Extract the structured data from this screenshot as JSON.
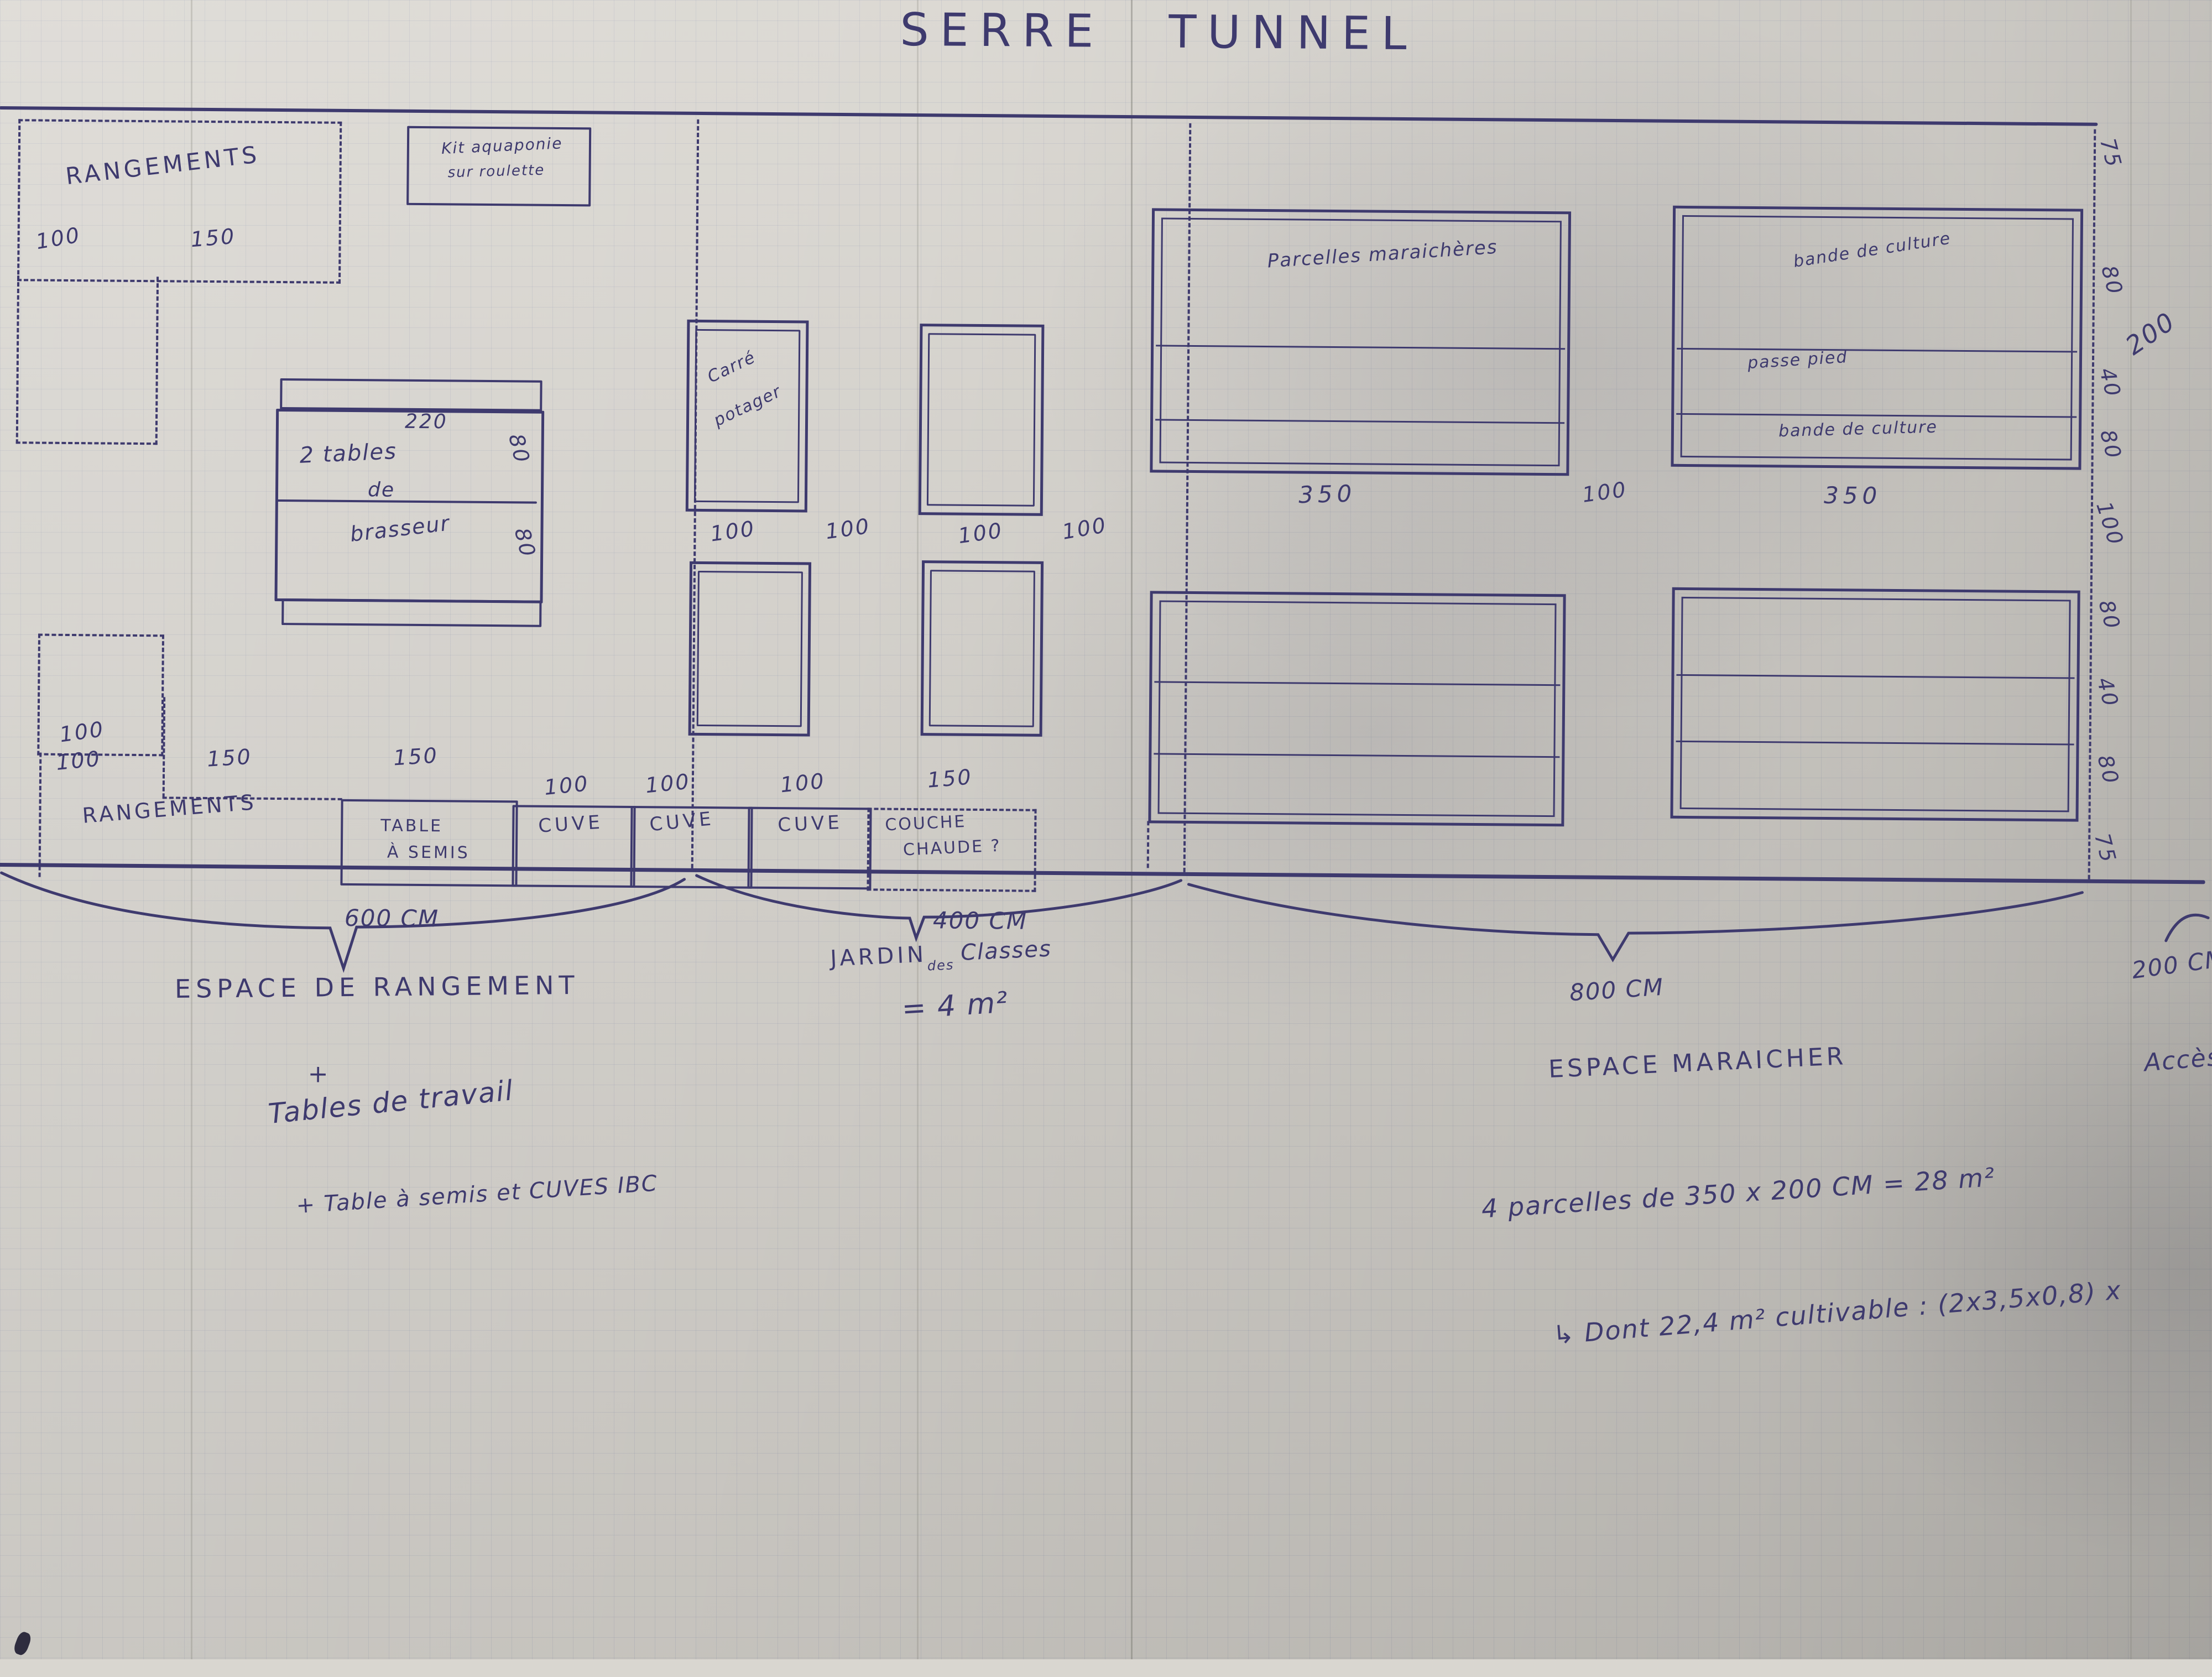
{
  "title": "SERRE TUNNEL",
  "rangement": {
    "zone_label_top": "RANGEMENTS",
    "zone_top_dim_a": "100",
    "zone_top_dim_b": "150",
    "kit_line1": "Kit aquaponie",
    "kit_line2": "sur roulette",
    "tables_dim_top": "220",
    "tables_line1": "2 tables",
    "tables_line2": "de",
    "tables_line3": "brasseur",
    "tables_side_dims": [
      "80",
      "80"
    ],
    "bottom_zone_dim": "100",
    "bottom_zone_label": "RANGEMENTS",
    "row_dim_a": "100",
    "row_dim_b": "150",
    "row_dim_c": "150",
    "semis_line1": "TABLE",
    "semis_line2": "À SEMIS",
    "brace_label": "600 CM",
    "section_name": "ESPACE DE RANGEMENT",
    "plus_sign": "+",
    "note1": "Tables de travail",
    "note2": "+ Table à semis et CUVES IBC"
  },
  "jardin": {
    "square_line1": "Carré",
    "square_line2": "potager",
    "row1_dims": [
      "100",
      "100",
      "100",
      "100"
    ],
    "cuve_labels": [
      "CUVE",
      "CUVE",
      "CUVE"
    ],
    "cuve_dims": [
      "100",
      "100",
      "100"
    ],
    "couche_dim": "150",
    "couche_line1": "COUCHE",
    "couche_line2": "CHAUDE ?",
    "brace_label": "400 CM",
    "name_main": "JARDIN",
    "name_small": "des",
    "name_tail": "Classes",
    "area_note": "= 4 m²"
  },
  "maraicher": {
    "parcel1_label": "Parcelles maraichères",
    "parcel1_dim": "350",
    "gap_dim": "100",
    "parcel2_bands": [
      "bande de culture",
      "passe pied",
      "bande de culture"
    ],
    "parcel2_dim": "350",
    "right_dims_top": [
      "75",
      "80",
      "40",
      "80",
      "100"
    ],
    "right_dim_total": "200",
    "right_dims_bottom": [
      "80",
      "40",
      "80",
      "75"
    ],
    "brace_label": "800 CM",
    "section_name": "ESPACE MARAICHER",
    "note1": "4 parcelles de 350 x 200 CM = 28 m²",
    "note2": "↳ Dont 22,4 m² cultivable : (2x3,5x0,8) x"
  },
  "acces": {
    "brace_label": "200 CM",
    "name": "Accès"
  },
  "colors": {
    "ink": "#3e3a6e",
    "paper": "#d9d6d0"
  }
}
